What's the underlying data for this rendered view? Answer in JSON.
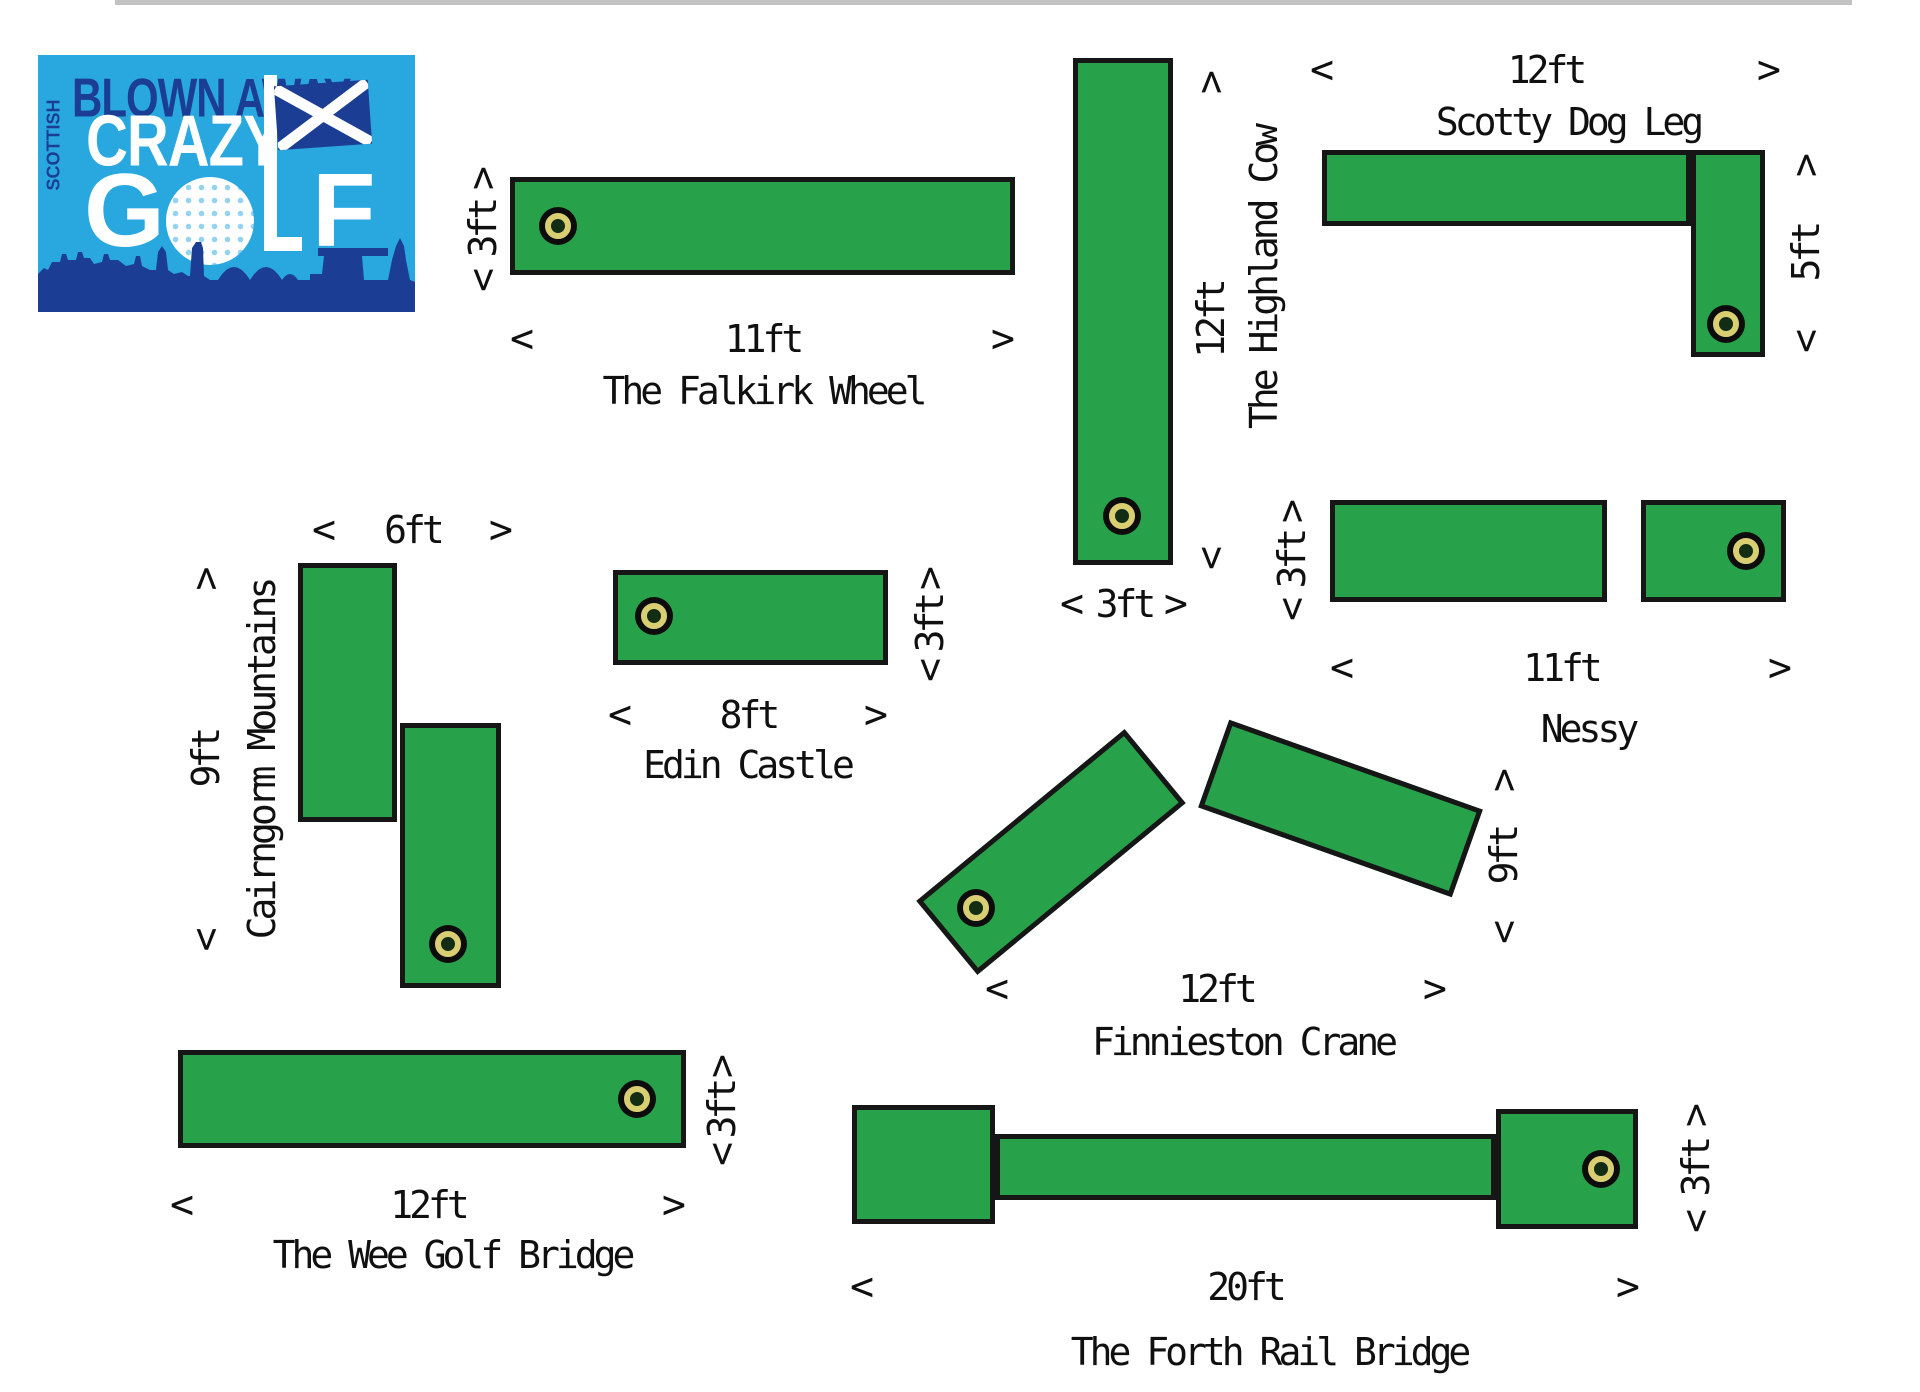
{
  "page": {
    "background": "#ffffff",
    "top_rule_color": "#c3c3c3"
  },
  "glyphs": {
    "lt": "<",
    "gt": ">"
  },
  "colors": {
    "felt_green": "#27a24b",
    "outline_black": "#161616",
    "cup_ring_yellow": "#d9cf72",
    "text": "#101010",
    "logo_light_blue": "#29a8e0",
    "logo_navy": "#1b3e94",
    "logo_white": "#ffffff"
  },
  "logo": {
    "brand_top": "BLOWN AWAY",
    "brand_side": "SCOTTISH",
    "brand_mid": "CRAZY",
    "golf_g": "G",
    "golf_f": "F"
  },
  "holes": {
    "falkirk": {
      "name": "The Falkirk Wheel",
      "length": "11ft",
      "width": "3ft"
    },
    "highland": {
      "name": "The Highland Cow",
      "length": "12ft",
      "width": "3ft"
    },
    "scotty": {
      "name": "Scotty Dog Leg",
      "length": "12ft",
      "width": "5ft"
    },
    "nessy": {
      "name": "Nessy",
      "length": "11ft",
      "width": "3ft"
    },
    "cairngorm": {
      "name": "Cairngorm Mountains",
      "length": "6ft",
      "width": "9ft"
    },
    "edin": {
      "name": "Edin Castle",
      "length": "8ft",
      "width": "3ft"
    },
    "finnieston": {
      "name": "Finnieston Crane",
      "length": "12ft",
      "width": "9ft"
    },
    "wee": {
      "name": "The Wee Golf Bridge",
      "length": "12ft",
      "width": "3ft"
    },
    "forth": {
      "name": "The Forth Rail Bridge",
      "length": "20ft",
      "width": "3ft"
    }
  }
}
